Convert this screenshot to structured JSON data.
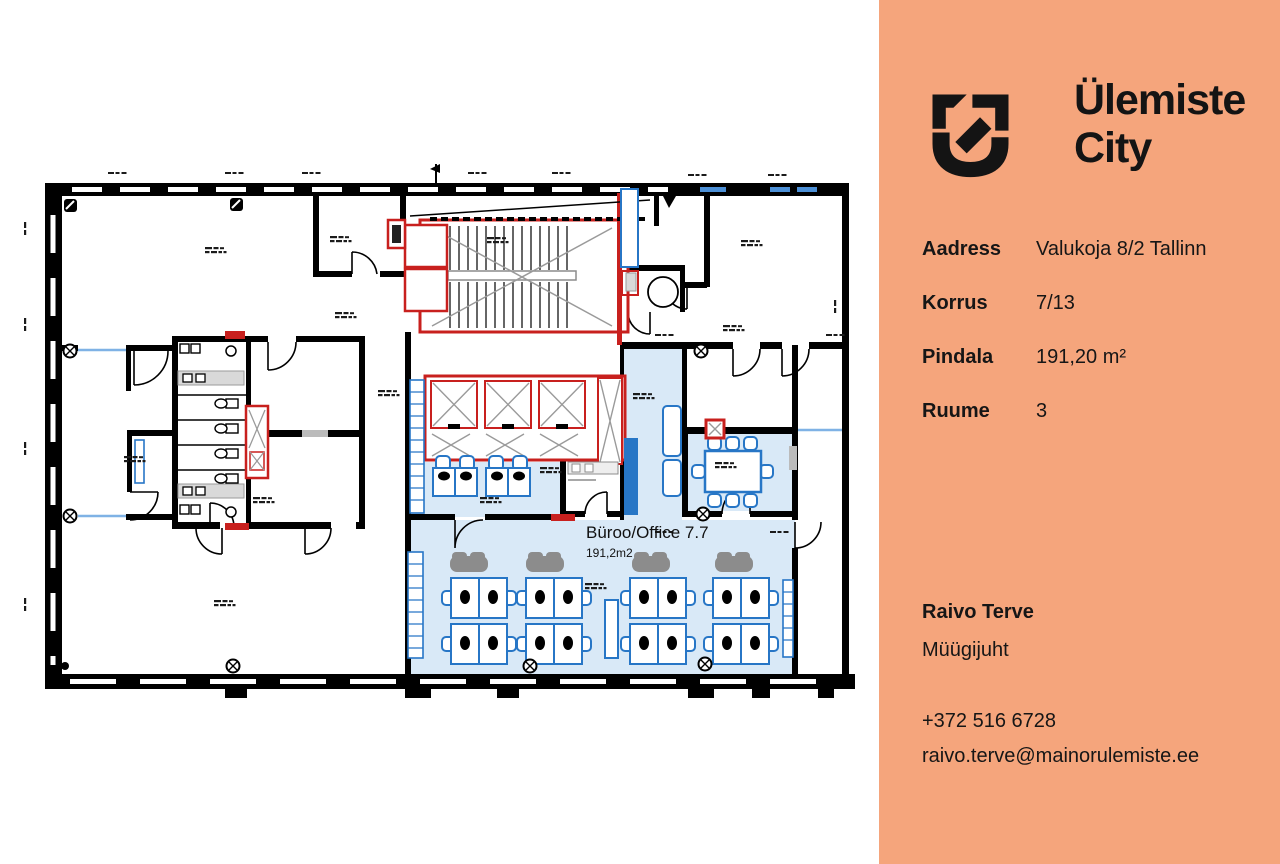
{
  "floorplan": {
    "room_label": "Büroo/Office 7.7",
    "room_area_label": "191,2m2",
    "highlight_color": "#D9E9F7",
    "wall_color": "#000000",
    "core_outline_color": "#C8201E",
    "furniture_color": "#2776C6",
    "open_office_desk_groups": 4,
    "meeting_room_seats": 8
  },
  "panel": {
    "background_color": "#F5A57C",
    "text_color": "#161616",
    "logo": {
      "icon": "ulemiste-city-logo-icon",
      "line1": "Ülemiste",
      "line2": "City"
    },
    "details": [
      {
        "label": "Aadress",
        "value": "Valukoja 8/2 Tallinn"
      },
      {
        "label": "Korrus",
        "value": "7/13"
      },
      {
        "label": "Pindala",
        "value": "191,20 m²"
      },
      {
        "label": "Ruume",
        "value": "3"
      }
    ],
    "contact": {
      "name": "Raivo Terve",
      "role": "Müügijuht",
      "phone": "+372 516 6728",
      "email": "raivo.terve@mainorulemiste.ee"
    }
  }
}
